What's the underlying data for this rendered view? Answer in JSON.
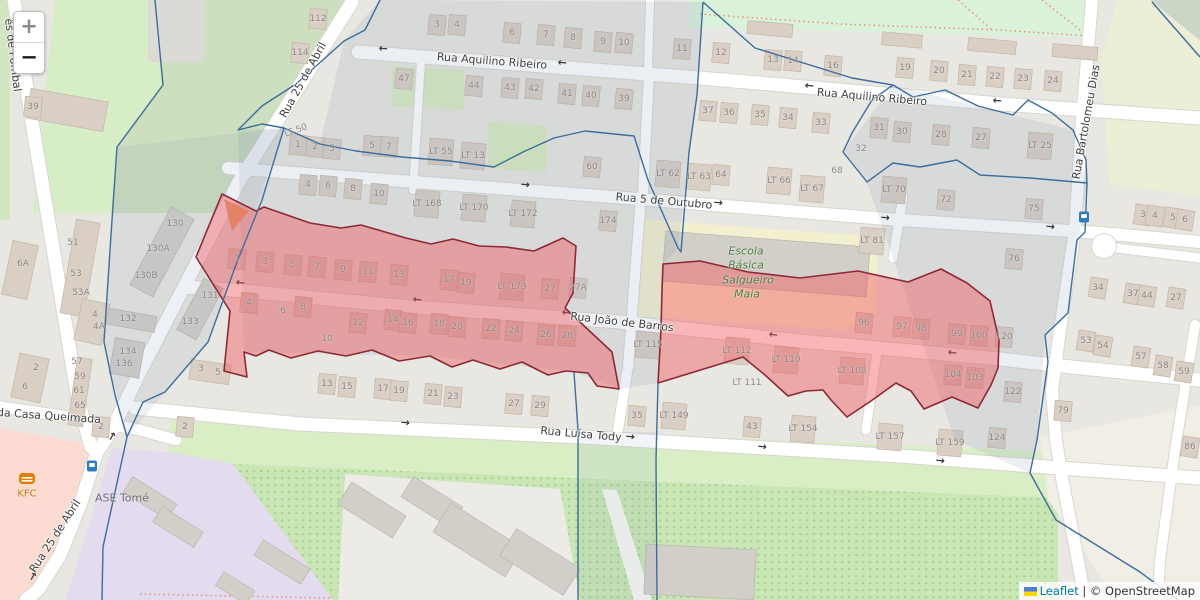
{
  "controls": {
    "zoom_in": "+",
    "zoom_out": "−"
  },
  "attribution": {
    "leaflet": "Leaflet",
    "sep": "|",
    "copyright": "© OpenStreetMap"
  },
  "colors": {
    "highlight_fill": "rgba(240,80,85,0.42)",
    "highlight_stroke": "#8d2836",
    "boundary_line": "#3c6d9e",
    "street_text": "#3e3e3e",
    "parcel_text": "#8b8885",
    "school_text": "#4e7d41",
    "fastfood_text": "#d27300",
    "link": "#0078A8"
  },
  "streets": [
    {
      "name": "Rua Aquilino Ribeiro",
      "x": 492,
      "y": 61,
      "rot": 4.5
    },
    {
      "name": "Rua Aquilino Ribeiro",
      "x": 872,
      "y": 97,
      "rot": 5
    },
    {
      "name": "Rua 5 de Outubro",
      "x": 664,
      "y": 201,
      "rot": 5
    },
    {
      "name": "Rua João de Barros",
      "x": 622,
      "y": 322,
      "rot": 6.5
    },
    {
      "name": "Rua Luísa Tody",
      "x": 581,
      "y": 434,
      "rot": 5
    },
    {
      "name": "Rua 25 de Abril",
      "x": 303,
      "y": 80,
      "rot": -61
    },
    {
      "name": "Rua 25 de Abril",
      "x": 55,
      "y": 536,
      "rot": -57
    },
    {
      "name": "Rua Bartolomeu Dias",
      "x": 1086,
      "y": 122,
      "rot": -80
    },
    {
      "name": "da Casa Queimada",
      "x": 49,
      "y": 416,
      "rot": 4
    },
    {
      "name": "ês de Pombal",
      "x": 13,
      "y": 55,
      "rot": 83
    }
  ],
  "pois": {
    "school": {
      "lines": [
        [
          "Escola",
          746,
          251
        ],
        [
          "Básica",
          746,
          265
        ],
        [
          "Salgueiro",
          748,
          280
        ],
        [
          "Maia",
          747,
          294
        ]
      ]
    },
    "kfc": {
      "name": "KFC",
      "x": 27,
      "y": 494
    },
    "ase": {
      "name": "ASE Tomé",
      "x": 122,
      "y": 498
    }
  },
  "parcels": [
    [
      "39",
      33,
      107
    ],
    [
      "112",
      318,
      19
    ],
    [
      "114",
      300,
      53
    ],
    [
      "3",
      437,
      25
    ],
    [
      "4",
      457,
      25
    ],
    [
      "6",
      512,
      33
    ],
    [
      "7",
      546,
      35
    ],
    [
      "8",
      573,
      38
    ],
    [
      "9",
      603,
      42
    ],
    [
      "10",
      624,
      43
    ],
    [
      "47",
      404,
      79
    ],
    [
      "44",
      474,
      86
    ],
    [
      "43",
      510,
      88
    ],
    [
      "42",
      534,
      89
    ],
    [
      "41",
      567,
      94
    ],
    [
      "40",
      591,
      96
    ],
    [
      "39",
      624,
      99
    ],
    [
      "11",
      682,
      49
    ],
    [
      "12",
      721,
      53
    ],
    [
      "13",
      773,
      60
    ],
    [
      "14",
      793,
      61
    ],
    [
      "16",
      833,
      66
    ],
    [
      "19",
      905,
      68
    ],
    [
      "20",
      939,
      71
    ],
    [
      "21",
      967,
      75
    ],
    [
      "22",
      995,
      77
    ],
    [
      "23",
      1023,
      79
    ],
    [
      "24",
      1053,
      81
    ],
    [
      "37",
      708,
      111
    ],
    [
      "36",
      729,
      113
    ],
    [
      "35",
      760,
      115
    ],
    [
      "34",
      788,
      118
    ],
    [
      "33",
      821,
      123
    ],
    [
      "31",
      879,
      128
    ],
    [
      "30",
      902,
      132
    ],
    [
      "32",
      861,
      149,
      1
    ],
    [
      "28",
      941,
      135
    ],
    [
      "27",
      981,
      138
    ],
    [
      "LT 25",
      1040,
      146
    ],
    [
      "1",
      298,
      145
    ],
    [
      "2",
      315,
      147
    ],
    [
      "3",
      332,
      149
    ],
    [
      "5",
      372,
      146
    ],
    [
      "7",
      389,
      147
    ],
    [
      "LT 55",
      441,
      152
    ],
    [
      "LT 13",
      473,
      156
    ],
    [
      "LT 50",
      296,
      131,
      1,
      -20
    ],
    [
      "60",
      592,
      167
    ],
    [
      "LT 62",
      668,
      174
    ],
    [
      "LT 63",
      699,
      177
    ],
    [
      "64",
      721,
      175
    ],
    [
      "LT 66",
      779,
      181
    ],
    [
      "LT 67",
      812,
      189
    ],
    [
      "68",
      837,
      171,
      1
    ],
    [
      "LT 70",
      894,
      190
    ],
    [
      "72",
      946,
      200
    ],
    [
      "4",
      308,
      185
    ],
    [
      "6",
      328,
      186
    ],
    [
      "8",
      353,
      189
    ],
    [
      "10",
      379,
      194
    ],
    [
      "LT 168",
      427,
      204
    ],
    [
      "LT 170",
      474,
      208
    ],
    [
      "LT 172",
      523,
      214
    ],
    [
      "174",
      608,
      221
    ],
    [
      "LT 81",
      872,
      241
    ],
    [
      "76",
      1014,
      259
    ],
    [
      "75",
      1034,
      209
    ],
    [
      "130",
      175,
      224,
      1
    ],
    [
      "130A",
      158,
      249,
      1
    ],
    [
      "130B",
      146,
      276,
      1
    ],
    [
      "131",
      210,
      296,
      1
    ],
    [
      "133",
      190,
      322,
      1
    ],
    [
      "132",
      128,
      319,
      1
    ],
    [
      "134",
      128,
      352,
      1
    ],
    [
      "136",
      124,
      364,
      1
    ],
    [
      "6A",
      23,
      264,
      1
    ],
    [
      "51",
      73,
      243,
      1
    ],
    [
      "53",
      76,
      274,
      1
    ],
    [
      "53A",
      81,
      293,
      1
    ],
    [
      "4",
      95,
      315,
      1
    ],
    [
      "4A",
      99,
      327,
      1
    ],
    [
      "57",
      77,
      362,
      1
    ],
    [
      "59",
      80,
      377,
      1
    ],
    [
      "61",
      79,
      391,
      1
    ],
    [
      "65",
      80,
      406,
      1
    ],
    [
      "67",
      81,
      420,
      1
    ],
    [
      "2",
      101,
      427
    ],
    [
      "2",
      36,
      368,
      1
    ],
    [
      "6",
      25,
      387,
      1
    ],
    [
      "3",
      201,
      369,
      1
    ],
    [
      "5",
      218,
      373,
      1
    ],
    [
      "1",
      237,
      259
    ],
    [
      "3",
      265,
      262
    ],
    [
      "5",
      293,
      265
    ],
    [
      "7",
      317,
      267
    ],
    [
      "9",
      343,
      270
    ],
    [
      "11",
      368,
      272
    ],
    [
      "13",
      399,
      275
    ],
    [
      "17",
      449,
      280
    ],
    [
      "19",
      466,
      283
    ],
    [
      "LT 179",
      512,
      287
    ],
    [
      "27",
      550,
      289
    ],
    [
      "27A",
      578,
      288
    ],
    [
      "4",
      249,
      303
    ],
    [
      "6",
      283,
      311,
      1
    ],
    [
      "8",
      303,
      307
    ],
    [
      "10",
      327,
      339,
      1
    ],
    [
      "12",
      358,
      323
    ],
    [
      "14",
      393,
      320
    ],
    [
      "16",
      408,
      323
    ],
    [
      "18",
      439,
      324
    ],
    [
      "20",
      457,
      327
    ],
    [
      "22",
      491,
      329
    ],
    [
      "24",
      514,
      331
    ],
    [
      "26",
      546,
      335
    ],
    [
      "28",
      567,
      336
    ],
    [
      "13",
      327,
      384
    ],
    [
      "15",
      347,
      387
    ],
    [
      "17",
      383,
      389
    ],
    [
      "19",
      399,
      391
    ],
    [
      "21",
      433,
      394
    ],
    [
      "23",
      453,
      397
    ],
    [
      "27",
      514,
      404
    ],
    [
      "29",
      540,
      406
    ],
    [
      "35",
      637,
      416
    ],
    [
      "LT 149",
      674,
      416
    ],
    [
      "43",
      752,
      427
    ],
    [
      "LT 154",
      803,
      429
    ],
    [
      "LT 157",
      890,
      437
    ],
    [
      "LT 159",
      950,
      443
    ],
    [
      "LT 115",
      648,
      345
    ],
    [
      "LT 112",
      737,
      351
    ],
    [
      "LT 110",
      786,
      360
    ],
    [
      "LT 111",
      747,
      383,
      1
    ],
    [
      "LT 108",
      852,
      371
    ],
    [
      "96",
      864,
      323
    ],
    [
      "97",
      902,
      327
    ],
    [
      "98",
      921,
      329
    ],
    [
      "99",
      957,
      334
    ],
    [
      "100",
      979,
      336
    ],
    [
      "104",
      953,
      375
    ],
    [
      "103",
      975,
      378
    ],
    [
      "120",
      1004,
      337
    ],
    [
      "122",
      1013,
      392
    ],
    [
      "124",
      997,
      438
    ],
    [
      "3",
      1143,
      215
    ],
    [
      "4",
      1155,
      216
    ],
    [
      "5",
      1173,
      218
    ],
    [
      "6",
      1185,
      220
    ],
    [
      "34",
      1098,
      288
    ],
    [
      "37",
      1133,
      294
    ],
    [
      "44",
      1147,
      296
    ],
    [
      "27",
      1176,
      298
    ],
    [
      "53",
      1086,
      341
    ],
    [
      "54",
      1103,
      346
    ],
    [
      "57",
      1141,
      357
    ],
    [
      "58",
      1163,
      366
    ],
    [
      "59",
      1184,
      372
    ],
    [
      "79",
      1063,
      411
    ],
    [
      "86",
      1190,
      447
    ],
    [
      "2",
      185,
      427
    ]
  ]
}
